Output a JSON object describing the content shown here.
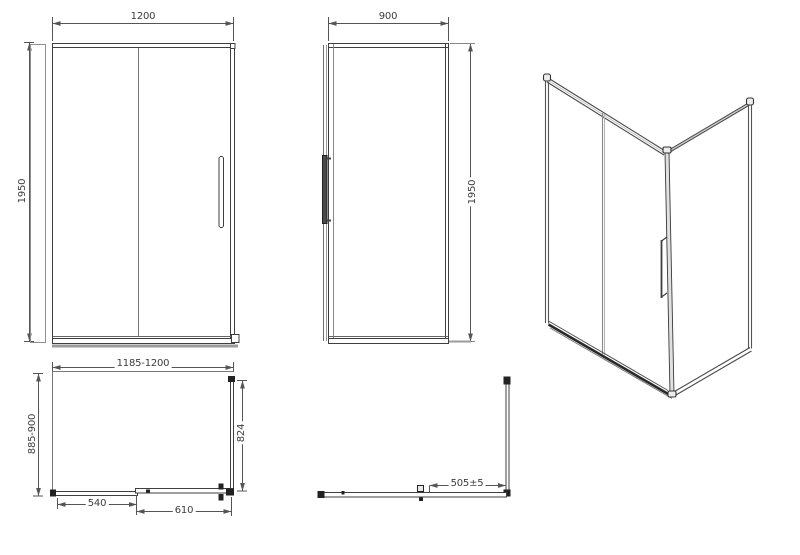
{
  "drawing": {
    "front_view": {
      "width": "1200",
      "height": "1950"
    },
    "side_view": {
      "width": "900",
      "height": "1950"
    },
    "plan_view": {
      "width_range": "1185-1200",
      "depth_range": "885-900",
      "side_glass_width": "824",
      "fixed_segment": "540",
      "door_segment": "610"
    },
    "corner_view": {
      "opening_width": "505±5"
    }
  },
  "colors": {
    "line": "#3f3f3f",
    "light_line": "#9b9b9b",
    "text": "#3d3d3d",
    "background": "#ffffff"
  }
}
